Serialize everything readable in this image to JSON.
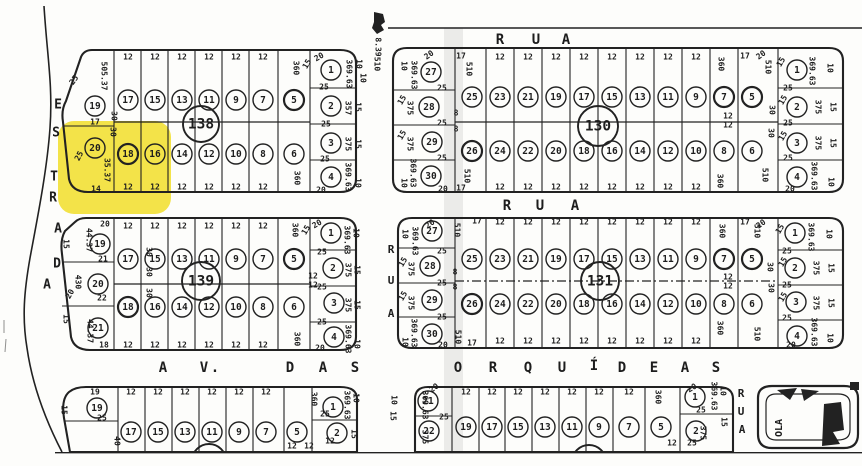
{
  "title": "Scanned cadastral plat map with lot 20 of block 138 highlighted",
  "colors": {
    "paper": "#fdfdfb",
    "ink": "#222222",
    "highlight": "#f2e139",
    "shade": "#8f8f8f"
  },
  "marker": {
    "label": "8.39"
  },
  "highlight": {
    "block": "138",
    "lot": "20"
  },
  "streets": {
    "left_road": "ESTRADA",
    "top_street": "RUA",
    "middle_street": "RUA",
    "vertical_street_upper": "RUA",
    "vertical_street_lower": "RUA",
    "bottom_avenue": "AV. DAS ORQUÍDEAS",
    "bottom_right_label": "OLA"
  },
  "blocks": [
    {
      "id": "138",
      "number": "138",
      "frontage": "12",
      "top_row": [
        "17",
        "15",
        "13",
        "11",
        "9",
        "7",
        "5"
      ],
      "bottom_row": [
        "18",
        "16",
        "14",
        "12",
        "10",
        "8",
        "6"
      ],
      "left_col": [
        "19",
        "20"
      ],
      "right_col": [
        "1",
        "2",
        "3",
        "4"
      ],
      "labels": [
        {
          "t": "505.37",
          "x": 104,
          "y": 76,
          "r": 90
        },
        {
          "t": "25",
          "x": 74,
          "y": 80,
          "r": -55
        },
        {
          "t": "17",
          "x": 95,
          "y": 122
        },
        {
          "t": "30",
          "x": 114,
          "y": 116,
          "r": 90
        },
        {
          "t": "30",
          "x": 113,
          "y": 132,
          "r": 90
        },
        {
          "t": "25",
          "x": 79,
          "y": 156,
          "r": -62
        },
        {
          "t": "35.37",
          "x": 107,
          "y": 170,
          "r": 90
        },
        {
          "t": "14",
          "x": 96,
          "y": 189
        },
        {
          "t": "360",
          "x": 296,
          "y": 68,
          "r": 90
        },
        {
          "t": "360",
          "x": 297,
          "y": 178,
          "r": 90
        },
        {
          "t": "20",
          "x": 319,
          "y": 57,
          "r": -30
        },
        {
          "t": "15",
          "x": 307,
          "y": 64,
          "r": -60
        },
        {
          "t": "369.63",
          "x": 349,
          "y": 74,
          "r": 90
        },
        {
          "t": "10",
          "x": 359,
          "y": 64,
          "r": 90
        },
        {
          "t": "25",
          "x": 324,
          "y": 87
        },
        {
          "t": "357",
          "x": 348,
          "y": 108,
          "r": 90
        },
        {
          "t": "15",
          "x": 358,
          "y": 107,
          "r": 90
        },
        {
          "t": "25",
          "x": 326,
          "y": 124
        },
        {
          "t": "375",
          "x": 348,
          "y": 144,
          "r": 90
        },
        {
          "t": "15",
          "x": 358,
          "y": 144,
          "r": 90
        },
        {
          "t": "25",
          "x": 325,
          "y": 159
        },
        {
          "t": "369.63",
          "x": 348,
          "y": 177,
          "r": 90
        },
        {
          "t": "10",
          "x": 358,
          "y": 183,
          "r": 90
        },
        {
          "t": "20",
          "x": 321,
          "y": 190
        },
        {
          "t": "510",
          "x": 377,
          "y": 64,
          "r": 90
        },
        {
          "t": "10",
          "x": 363,
          "y": 78,
          "r": 90
        }
      ]
    },
    {
      "id": "130",
      "number": "130",
      "frontage": "12",
      "top_row": [
        "25",
        "23",
        "21",
        "19",
        "17",
        "15",
        "13",
        "11",
        "9",
        "7",
        "5"
      ],
      "bottom_row": [
        "26",
        "24",
        "22",
        "20",
        "18",
        "16",
        "14",
        "12",
        "10",
        "8",
        "6"
      ],
      "left_col": [
        "27",
        "28",
        "29",
        "30"
      ],
      "right_col": [
        "1",
        "2",
        "3",
        "4"
      ],
      "labels": [
        {
          "t": "20",
          "x": 429,
          "y": 55,
          "r": -35
        },
        {
          "t": "10",
          "x": 404,
          "y": 66,
          "r": 90
        },
        {
          "t": "369.63",
          "x": 414,
          "y": 75,
          "r": 90
        },
        {
          "t": "25",
          "x": 442,
          "y": 88
        },
        {
          "t": "15",
          "x": 402,
          "y": 100,
          "r": -60
        },
        {
          "t": "375",
          "x": 410,
          "y": 108,
          "r": 90
        },
        {
          "t": "25",
          "x": 442,
          "y": 123
        },
        {
          "t": "15",
          "x": 402,
          "y": 135,
          "r": -60
        },
        {
          "t": "375",
          "x": 410,
          "y": 144,
          "r": 90
        },
        {
          "t": "25",
          "x": 442,
          "y": 158
        },
        {
          "t": "369.63",
          "x": 413,
          "y": 173,
          "r": 90
        },
        {
          "t": "10",
          "x": 404,
          "y": 183,
          "r": 90
        },
        {
          "t": "20",
          "x": 443,
          "y": 189
        },
        {
          "t": "17",
          "x": 461,
          "y": 56
        },
        {
          "t": "510",
          "x": 469,
          "y": 69,
          "r": 90
        },
        {
          "t": "8",
          "x": 456,
          "y": 113
        },
        {
          "t": "8",
          "x": 456,
          "y": 129
        },
        {
          "t": "510",
          "x": 467,
          "y": 176,
          "r": 90
        },
        {
          "t": "17",
          "x": 461,
          "y": 188
        },
        {
          "t": "360",
          "x": 721,
          "y": 64,
          "r": 90
        },
        {
          "t": "12",
          "x": 728,
          "y": 116
        },
        {
          "t": "12",
          "x": 728,
          "y": 125
        },
        {
          "t": "360",
          "x": 720,
          "y": 181,
          "r": 90
        },
        {
          "t": "17",
          "x": 745,
          "y": 56
        },
        {
          "t": "510",
          "x": 768,
          "y": 67,
          "r": 90
        },
        {
          "t": "30",
          "x": 772,
          "y": 110,
          "r": 90
        },
        {
          "t": "30",
          "x": 771,
          "y": 133,
          "r": 90
        },
        {
          "t": "510",
          "x": 765,
          "y": 175,
          "r": 90
        },
        {
          "t": "20",
          "x": 761,
          "y": 55,
          "r": -35
        },
        {
          "t": "15",
          "x": 781,
          "y": 62,
          "r": -60
        },
        {
          "t": "369.63",
          "x": 812,
          "y": 71,
          "r": 90
        },
        {
          "t": "10",
          "x": 830,
          "y": 68,
          "r": 90
        },
        {
          "t": "25",
          "x": 788,
          "y": 88
        },
        {
          "t": "15",
          "x": 783,
          "y": 100,
          "r": -60
        },
        {
          "t": "375",
          "x": 818,
          "y": 107,
          "r": 90
        },
        {
          "t": "15",
          "x": 833,
          "y": 107,
          "r": 90
        },
        {
          "t": "25",
          "x": 788,
          "y": 123
        },
        {
          "t": "15",
          "x": 783,
          "y": 136,
          "r": -60
        },
        {
          "t": "375",
          "x": 818,
          "y": 143,
          "r": 90
        },
        {
          "t": "15",
          "x": 833,
          "y": 143,
          "r": 90
        },
        {
          "t": "25",
          "x": 788,
          "y": 158
        },
        {
          "t": "369.63",
          "x": 814,
          "y": 176,
          "r": 90
        },
        {
          "t": "10",
          "x": 831,
          "y": 182,
          "r": 90
        },
        {
          "t": "20",
          "x": 790,
          "y": 189
        }
      ]
    },
    {
      "id": "139",
      "number": "139",
      "frontage": "12",
      "top_row": [
        "17",
        "15",
        "13",
        "11",
        "9",
        "7",
        "5"
      ],
      "bottom_row": [
        "18",
        "16",
        "14",
        "12",
        "10",
        "8",
        "6"
      ],
      "left_col": [
        "19",
        "20",
        "21"
      ],
      "right_col": [
        "1",
        "2",
        "3",
        "4"
      ],
      "labels": [
        {
          "t": "20",
          "x": 105,
          "y": 224
        },
        {
          "t": "44.37",
          "x": 89,
          "y": 240,
          "r": 90
        },
        {
          "t": "15",
          "x": 66,
          "y": 244,
          "r": 90
        },
        {
          "t": "21",
          "x": 103,
          "y": 259
        },
        {
          "t": "430",
          "x": 78,
          "y": 282,
          "r": 90
        },
        {
          "t": "20",
          "x": 70,
          "y": 294,
          "r": -60
        },
        {
          "t": "22",
          "x": 102,
          "y": 298
        },
        {
          "t": "15",
          "x": 66,
          "y": 319,
          "r": 90
        },
        {
          "t": "44.37",
          "x": 90,
          "y": 331,
          "r": 90
        },
        {
          "t": "18",
          "x": 104,
          "y": 345
        },
        {
          "t": "30",
          "x": 149,
          "y": 252,
          "r": 90
        },
        {
          "t": "30",
          "x": 149,
          "y": 272,
          "r": 90
        },
        {
          "t": "30",
          "x": 149,
          "y": 293,
          "r": 90
        },
        {
          "t": "360",
          "x": 295,
          "y": 230,
          "r": 90
        },
        {
          "t": "360",
          "x": 297,
          "y": 339,
          "r": 90
        },
        {
          "t": "20",
          "x": 317,
          "y": 224,
          "r": -30
        },
        {
          "t": "15",
          "x": 306,
          "y": 230,
          "r": -60
        },
        {
          "t": "369.63",
          "x": 347,
          "y": 240,
          "r": 90
        },
        {
          "t": "10",
          "x": 356,
          "y": 233,
          "r": 90
        },
        {
          "t": "25",
          "x": 322,
          "y": 252
        },
        {
          "t": "375",
          "x": 348,
          "y": 270,
          "r": 90
        },
        {
          "t": "15",
          "x": 357,
          "y": 270,
          "r": 90
        },
        {
          "t": "25",
          "x": 322,
          "y": 287
        },
        {
          "t": "375",
          "x": 348,
          "y": 305,
          "r": 90
        },
        {
          "t": "15",
          "x": 357,
          "y": 305,
          "r": 90
        },
        {
          "t": "25",
          "x": 322,
          "y": 322
        },
        {
          "t": "369.63",
          "x": 348,
          "y": 339,
          "r": 90
        },
        {
          "t": "10",
          "x": 357,
          "y": 344,
          "r": 90
        },
        {
          "t": "20",
          "x": 320,
          "y": 348
        },
        {
          "t": "12",
          "x": 313,
          "y": 276
        },
        {
          "t": "12",
          "x": 313,
          "y": 285
        }
      ]
    },
    {
      "id": "131",
      "number": "131",
      "frontage": "12",
      "top_row": [
        "25",
        "23",
        "21",
        "19",
        "17",
        "15",
        "13",
        "11",
        "9",
        "7",
        "5"
      ],
      "bottom_row": [
        "26",
        "24",
        "22",
        "20",
        "18",
        "16",
        "14",
        "12",
        "10",
        "8",
        "6"
      ],
      "left_col": [
        "27",
        "28",
        "29",
        "30"
      ],
      "right_col": [
        "1",
        "2",
        "3",
        "4"
      ],
      "labels": [
        {
          "t": "20",
          "x": 430,
          "y": 224,
          "r": -35
        },
        {
          "t": "10",
          "x": 405,
          "y": 234,
          "r": 90
        },
        {
          "t": "369.63",
          "x": 415,
          "y": 241,
          "r": 90
        },
        {
          "t": "25",
          "x": 442,
          "y": 251
        },
        {
          "t": "15",
          "x": 403,
          "y": 262,
          "r": -60
        },
        {
          "t": "375",
          "x": 411,
          "y": 269,
          "r": 90
        },
        {
          "t": "25",
          "x": 442,
          "y": 283
        },
        {
          "t": "15",
          "x": 403,
          "y": 296,
          "r": -60
        },
        {
          "t": "375",
          "x": 411,
          "y": 303,
          "r": 90
        },
        {
          "t": "25",
          "x": 442,
          "y": 317
        },
        {
          "t": "369.63",
          "x": 414,
          "y": 333,
          "r": 90
        },
        {
          "t": "10",
          "x": 405,
          "y": 342,
          "r": 90
        },
        {
          "t": "20",
          "x": 443,
          "y": 345
        },
        {
          "t": "510",
          "x": 457,
          "y": 230,
          "r": 90
        },
        {
          "t": "17",
          "x": 477,
          "y": 221
        },
        {
          "t": "8",
          "x": 455,
          "y": 272
        },
        {
          "t": "8",
          "x": 455,
          "y": 287
        },
        {
          "t": "510",
          "x": 458,
          "y": 337,
          "r": 90
        },
        {
          "t": "17",
          "x": 472,
          "y": 343
        },
        {
          "t": "360",
          "x": 722,
          "y": 231,
          "r": 90
        },
        {
          "t": "12",
          "x": 728,
          "y": 277
        },
        {
          "t": "12",
          "x": 728,
          "y": 286
        },
        {
          "t": "360",
          "x": 720,
          "y": 328,
          "r": 90
        },
        {
          "t": "17",
          "x": 745,
          "y": 222
        },
        {
          "t": "510",
          "x": 757,
          "y": 231,
          "r": 90
        },
        {
          "t": "30",
          "x": 770,
          "y": 267,
          "r": 90
        },
        {
          "t": "30",
          "x": 771,
          "y": 288,
          "r": 90
        },
        {
          "t": "510",
          "x": 757,
          "y": 334,
          "r": 90
        },
        {
          "t": "20",
          "x": 761,
          "y": 224,
          "r": -35
        },
        {
          "t": "15",
          "x": 780,
          "y": 229,
          "r": -60
        },
        {
          "t": "369.63",
          "x": 811,
          "y": 237,
          "r": 90
        },
        {
          "t": "10",
          "x": 829,
          "y": 234,
          "r": 90
        },
        {
          "t": "25",
          "x": 787,
          "y": 251
        },
        {
          "t": "15",
          "x": 783,
          "y": 262,
          "r": -60
        },
        {
          "t": "375",
          "x": 816,
          "y": 268,
          "r": 90
        },
        {
          "t": "15",
          "x": 831,
          "y": 268,
          "r": 90
        },
        {
          "t": "25",
          "x": 787,
          "y": 285
        },
        {
          "t": "15",
          "x": 783,
          "y": 297,
          "r": -60
        },
        {
          "t": "375",
          "x": 816,
          "y": 303,
          "r": 90
        },
        {
          "t": "15",
          "x": 831,
          "y": 303,
          "r": 90
        },
        {
          "t": "25",
          "x": 787,
          "y": 318
        },
        {
          "t": "369.63",
          "x": 814,
          "y": 332,
          "r": 90
        },
        {
          "t": "10",
          "x": 830,
          "y": 338,
          "r": 90
        },
        {
          "t": "20",
          "x": 791,
          "y": 345
        }
      ]
    },
    {
      "id": "bottom-left",
      "number": "",
      "frontage": "12",
      "top_row": [
        "17",
        "15",
        "13",
        "11",
        "9",
        "7",
        "5"
      ],
      "bottom_row": [],
      "left_col": [
        "19"
      ],
      "right_col": [
        "1",
        "2"
      ],
      "labels": [
        {
          "t": "19",
          "x": 95,
          "y": 392
        },
        {
          "t": "15",
          "x": 64,
          "y": 410,
          "r": 90
        },
        {
          "t": "25",
          "x": 102,
          "y": 418
        },
        {
          "t": "40",
          "x": 117,
          "y": 441,
          "r": 90
        },
        {
          "t": "360",
          "x": 314,
          "y": 399,
          "r": 90
        },
        {
          "t": "25",
          "x": 325,
          "y": 414
        },
        {
          "t": "369.63",
          "x": 347,
          "y": 405,
          "r": 90
        },
        {
          "t": "10",
          "x": 356,
          "y": 398,
          "r": 90
        },
        {
          "t": "12",
          "x": 330,
          "y": 441
        },
        {
          "t": "15",
          "x": 354,
          "y": 434,
          "r": 90
        },
        {
          "t": "12",
          "x": 292,
          "y": 446
        },
        {
          "t": "12",
          "x": 309,
          "y": 446
        }
      ]
    },
    {
      "id": "bottom-middle",
      "number": "",
      "frontage": "12",
      "top_row": [
        "19",
        "17",
        "15",
        "13",
        "11",
        "9",
        "7",
        "5"
      ],
      "bottom_row": [],
      "left_col": [
        "21",
        "22"
      ],
      "right_col": [
        "1",
        "2"
      ],
      "labels": [
        {
          "t": "20",
          "x": 434,
          "y": 388,
          "r": -35
        },
        {
          "t": "10",
          "x": 394,
          "y": 400,
          "r": 90
        },
        {
          "t": "15",
          "x": 393,
          "y": 416,
          "r": 90
        },
        {
          "t": "369.63",
          "x": 425,
          "y": 405,
          "r": 90
        },
        {
          "t": "25",
          "x": 444,
          "y": 417
        },
        {
          "t": "375",
          "x": 425,
          "y": 437,
          "r": 90
        },
        {
          "t": "360",
          "x": 658,
          "y": 397,
          "r": 90
        },
        {
          "t": "20",
          "x": 692,
          "y": 388,
          "r": -30
        },
        {
          "t": "369.63",
          "x": 714,
          "y": 396,
          "r": 90
        },
        {
          "t": "10",
          "x": 723,
          "y": 391,
          "r": 90
        },
        {
          "t": "25",
          "x": 701,
          "y": 410
        },
        {
          "t": "15",
          "x": 724,
          "y": 422,
          "r": 90
        },
        {
          "t": "375",
          "x": 703,
          "y": 433,
          "r": 90
        },
        {
          "t": "12",
          "x": 672,
          "y": 443
        },
        {
          "t": "25",
          "x": 692,
          "y": 443
        }
      ]
    }
  ]
}
